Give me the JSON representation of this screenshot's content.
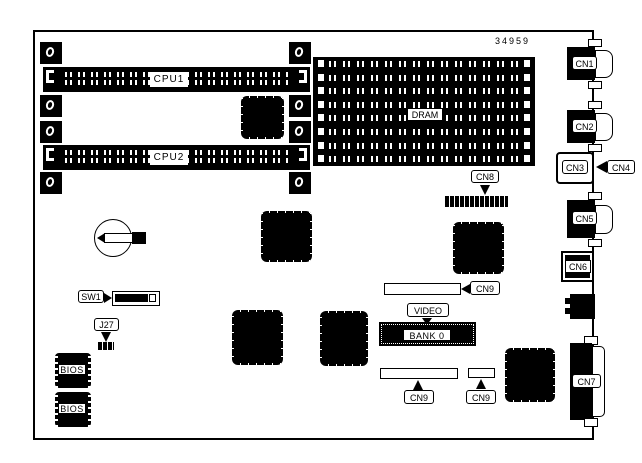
{
  "diagram": {
    "part_number": "34959",
    "board": {
      "cpu_slots": [
        {
          "id": "cpu1",
          "label": "CPU1"
        },
        {
          "id": "cpu2",
          "label": "CPU2"
        }
      ],
      "memory": {
        "dram_label": "DRAM",
        "dram_slot_count": 8,
        "video_label": "VIDEO",
        "bank0_label": "BANK 0"
      },
      "switches": {
        "sw1_label": "SW1",
        "j27_label": "J27"
      },
      "bios": {
        "chip1_label": "BIOS",
        "chip2_label": "BIOS"
      },
      "edge_connectors": {
        "cn1": "CN1",
        "cn2": "CN2",
        "cn3": "CN3",
        "cn4": "CN4",
        "cn5": "CN5",
        "cn6": "CN6",
        "cn7": "CN7"
      },
      "headers": {
        "cn8": "CN8",
        "cn9_top": "CN9",
        "cn9_bottom_left": "CN9",
        "cn9_bottom_right": "CN9"
      }
    },
    "colors": {
      "ink": "#000000",
      "paper": "#ffffff"
    }
  }
}
